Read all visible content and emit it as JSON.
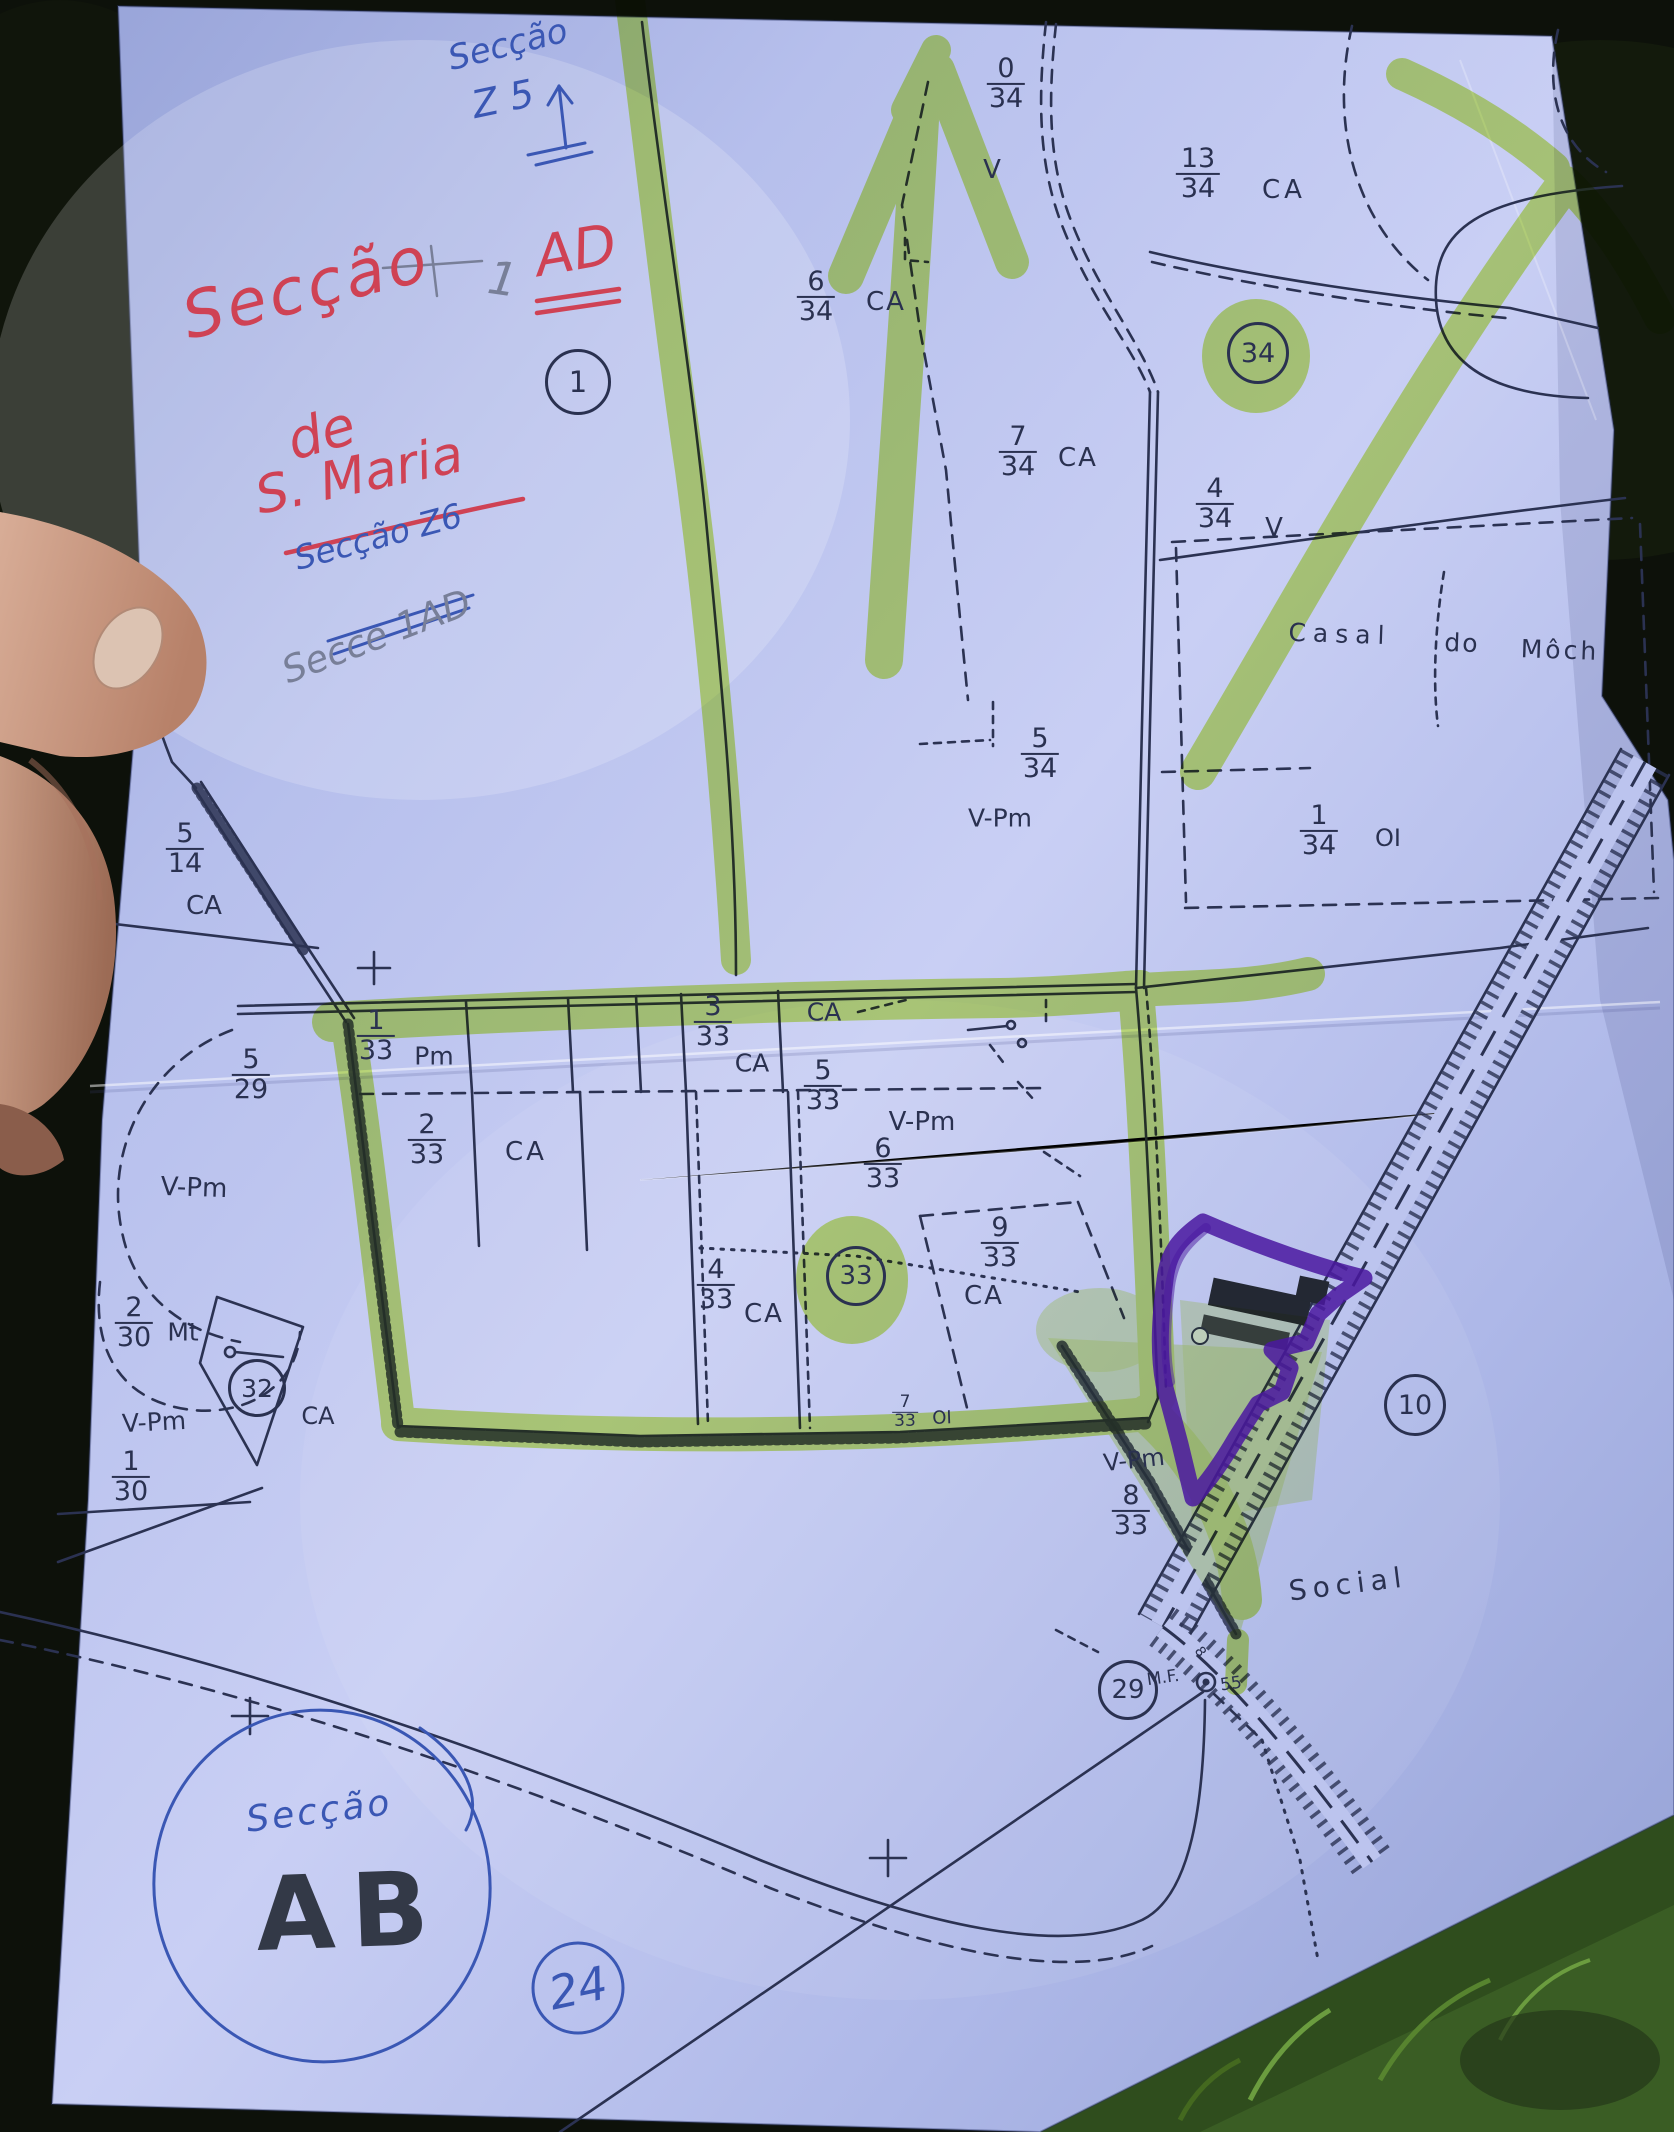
{
  "photo": {
    "paper_color": "#bcc4ee",
    "highlight_color": "#b6e42a",
    "purple_color": "#4a17a0",
    "ink_color": "#2a3150",
    "red_pen": "#cf4254",
    "blue_pen": "#3a57b4",
    "pencil": "#787f98"
  },
  "handwriting": {
    "red_seccao": "Secção",
    "red_ad": "AD",
    "red_de": "de",
    "red_maria": "S. Maria",
    "blue_top_line1": "Secção",
    "blue_top_line2": "Z 5",
    "blue_mid": "Secção Z6",
    "pencil_note": "Secce 1AD",
    "pencil_one": "1",
    "bottom_seccao": "Secção",
    "bottom_ab": "AB",
    "bottom_badge": "24"
  },
  "map": {
    "fractions": [
      {
        "n": "0",
        "d": "34",
        "x": 1006,
        "y": 84
      },
      {
        "n": "13",
        "d": "34",
        "x": 1198,
        "y": 174
      },
      {
        "n": "6",
        "d": "34",
        "x": 816,
        "y": 297
      },
      {
        "n": "7",
        "d": "34",
        "x": 1018,
        "y": 452
      },
      {
        "n": "4",
        "d": "34",
        "x": 1215,
        "y": 504
      },
      {
        "n": "5",
        "d": "34",
        "x": 1040,
        "y": 754
      },
      {
        "n": "1",
        "d": "34",
        "x": 1319,
        "y": 831
      },
      {
        "n": "5",
        "d": "14",
        "x": 185,
        "y": 849
      },
      {
        "n": "1",
        "d": "33",
        "x": 376,
        "y": 1036
      },
      {
        "n": "3",
        "d": "33",
        "x": 713,
        "y": 1022
      },
      {
        "n": "5",
        "d": "33",
        "x": 823,
        "y": 1086
      },
      {
        "n": "6",
        "d": "33",
        "x": 883,
        "y": 1164
      },
      {
        "n": "2",
        "d": "33",
        "x": 427,
        "y": 1140
      },
      {
        "n": "4",
        "d": "33",
        "x": 716,
        "y": 1285
      },
      {
        "n": "9",
        "d": "33",
        "x": 1000,
        "y": 1243
      },
      {
        "n": "7",
        "d": "33",
        "x": 905,
        "y": 1412,
        "small": true
      },
      {
        "n": "8",
        "d": "33",
        "x": 1131,
        "y": 1511
      },
      {
        "n": "5",
        "d": "29",
        "x": 251,
        "y": 1075
      },
      {
        "n": "2",
        "d": "30",
        "x": 134,
        "y": 1323
      },
      {
        "n": "1",
        "d": "30",
        "x": 131,
        "y": 1477
      }
    ],
    "texts": [
      {
        "t": "V",
        "x": 992,
        "y": 170,
        "s": 26
      },
      {
        "t": "CA",
        "x": 1284,
        "y": 190,
        "s": 26,
        "ls": 4
      },
      {
        "t": "CA",
        "x": 886,
        "y": 302,
        "s": 26,
        "ls": 2
      },
      {
        "t": "CA",
        "x": 1078,
        "y": 458,
        "s": 26,
        "ls": 2
      },
      {
        "t": "V",
        "x": 1274,
        "y": 528,
        "s": 26
      },
      {
        "t": "Casal",
        "x": 1340,
        "y": 634,
        "s": 25,
        "ls": 7,
        "r": 2
      },
      {
        "t": "do",
        "x": 1462,
        "y": 643,
        "s": 25,
        "ls": 2,
        "r": 2
      },
      {
        "t": "Môch",
        "x": 1560,
        "y": 650,
        "s": 25,
        "ls": 3,
        "r": 2
      },
      {
        "t": "V-Pm",
        "x": 1000,
        "y": 818,
        "s": 25
      },
      {
        "t": "OI",
        "x": 1388,
        "y": 838,
        "s": 24
      },
      {
        "t": "CA",
        "x": 204,
        "y": 906,
        "s": 26
      },
      {
        "t": "Pm",
        "x": 434,
        "y": 1056,
        "s": 25
      },
      {
        "t": "CA",
        "x": 824,
        "y": 1012,
        "s": 25
      },
      {
        "t": "CA",
        "x": 752,
        "y": 1063,
        "s": 25
      },
      {
        "t": "V-Pm",
        "x": 922,
        "y": 1122,
        "s": 26
      },
      {
        "t": "CA",
        "x": 526,
        "y": 1152,
        "s": 26,
        "ls": 3
      },
      {
        "t": "CA",
        "x": 764,
        "y": 1314,
        "s": 26,
        "ls": 2
      },
      {
        "t": "CA",
        "x": 984,
        "y": 1296,
        "s": 26,
        "ls": 2
      },
      {
        "t": "OI",
        "x": 942,
        "y": 1418,
        "s": 18,
        "r": -2
      },
      {
        "t": "V-Pm",
        "x": 1134,
        "y": 1460,
        "s": 24,
        "r": -6
      },
      {
        "t": "Social",
        "x": 1348,
        "y": 1584,
        "s": 28,
        "ls": 6,
        "r": -7
      },
      {
        "t": "CA",
        "x": 318,
        "y": 1416,
        "s": 24
      },
      {
        "t": "V-Pm",
        "x": 194,
        "y": 1188,
        "s": 26,
        "r": 2
      },
      {
        "t": "Mt",
        "x": 183,
        "y": 1332,
        "s": 25
      },
      {
        "t": "V-Pm",
        "x": 154,
        "y": 1422,
        "s": 25,
        "r": -3
      },
      {
        "t": "M.F.",
        "x": 1163,
        "y": 1678,
        "s": 17,
        "r": -8
      },
      {
        "t": "55",
        "x": 1231,
        "y": 1684,
        "s": 17,
        "r": -8
      },
      {
        "t": "8",
        "x": 1200,
        "y": 1652,
        "s": 14,
        "r": 55
      }
    ],
    "markers": [
      {
        "n": "1",
        "x": 578,
        "y": 382,
        "rad": 30
      },
      {
        "n": "34",
        "x": 1258,
        "y": 353,
        "rad": 28
      },
      {
        "n": "33",
        "x": 856,
        "y": 1276,
        "rad": 27
      },
      {
        "n": "32",
        "x": 257,
        "y": 1388,
        "rad": 26
      },
      {
        "n": "10",
        "x": 1415,
        "y": 1405,
        "rad": 28
      },
      {
        "n": "29",
        "x": 1128,
        "y": 1690,
        "rad": 27
      }
    ]
  }
}
